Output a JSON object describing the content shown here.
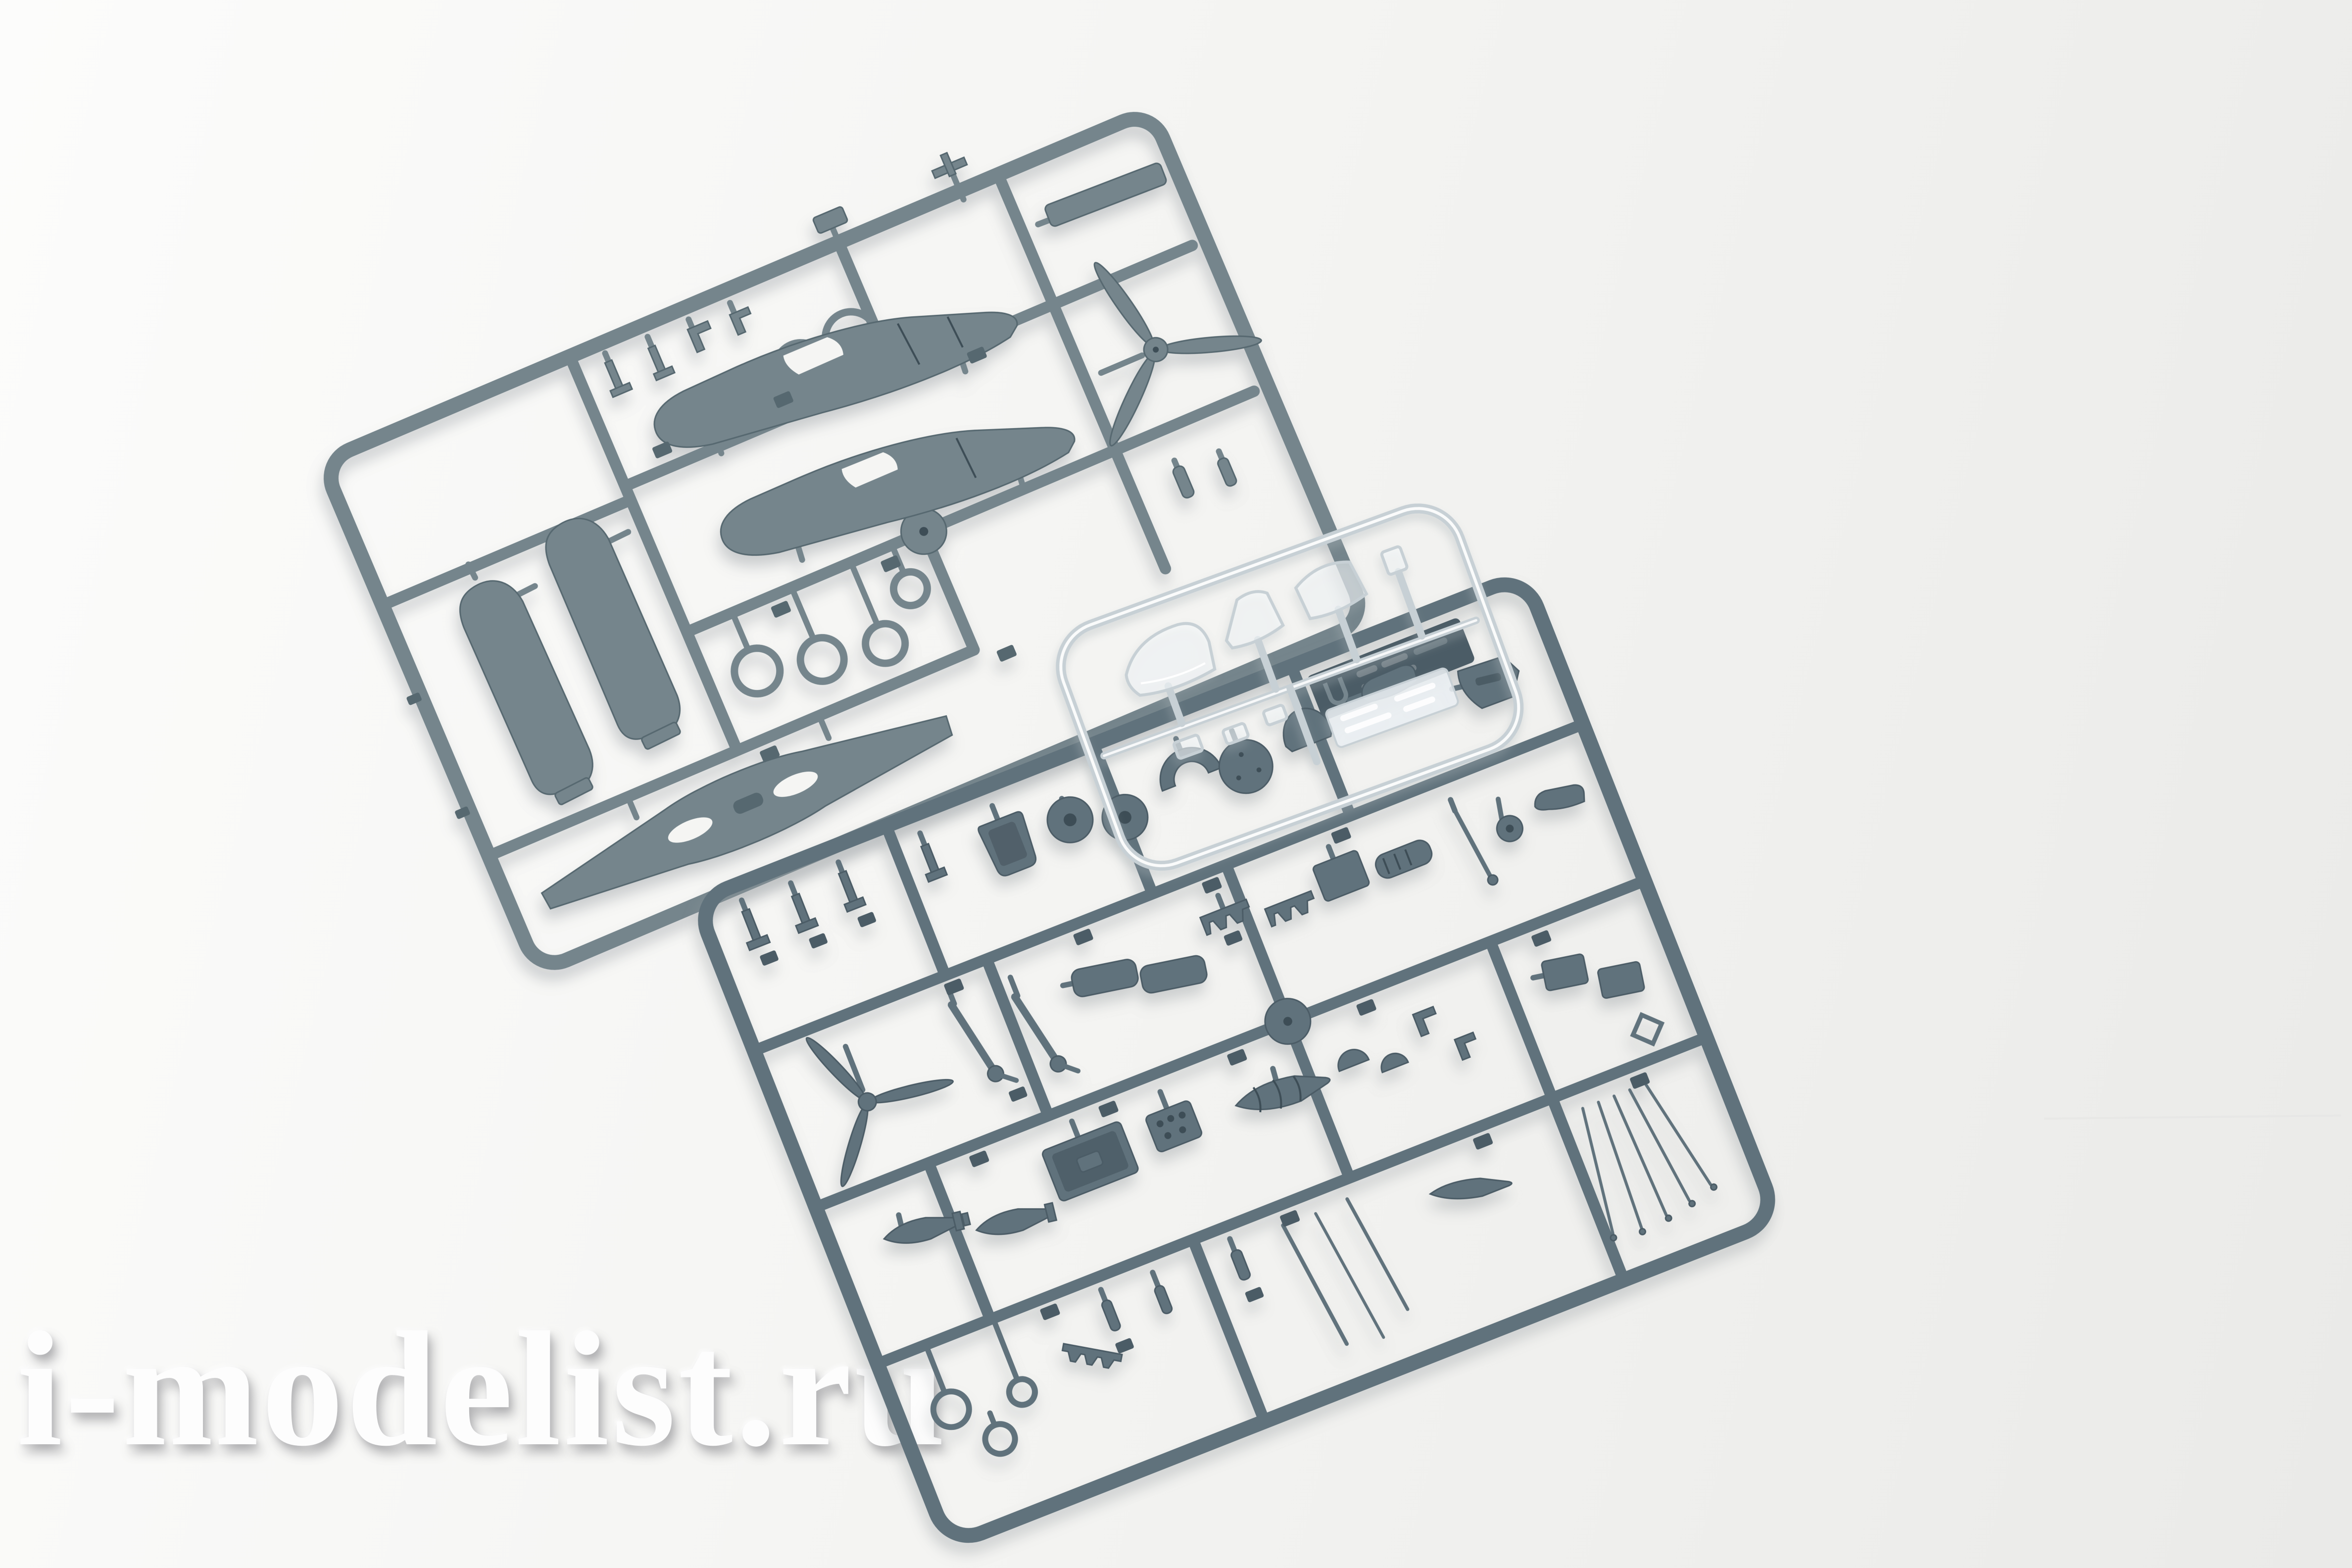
{
  "scene": {
    "description": "Product photo of a plastic scale-model aircraft kit: two large grey injection-moulded sprues (wings, fuselage halves, propellers, wheels, landing gear, bombs, drop tanks, cockpit details) and one small transparent sprue with canopy parts, lying on a white background",
    "watermark": {
      "text": "i-modelist.ru"
    }
  },
  "colors": {
    "background_light": "#fcfcfb",
    "background_mid": "#f5f5f3",
    "background_dark": "#eaeae8",
    "plastic_a": "#75858c",
    "plastic_a_dark": "#57686F",
    "plastic_b": "#61727c",
    "plastic_b_dark": "#4b5c66",
    "plastic_deep": "#3e4e57",
    "glass_stroke": "#c7d0d5",
    "glass_fill": "rgba(245,249,251,0.55)",
    "watermark_text": "#fdfdfd"
  }
}
